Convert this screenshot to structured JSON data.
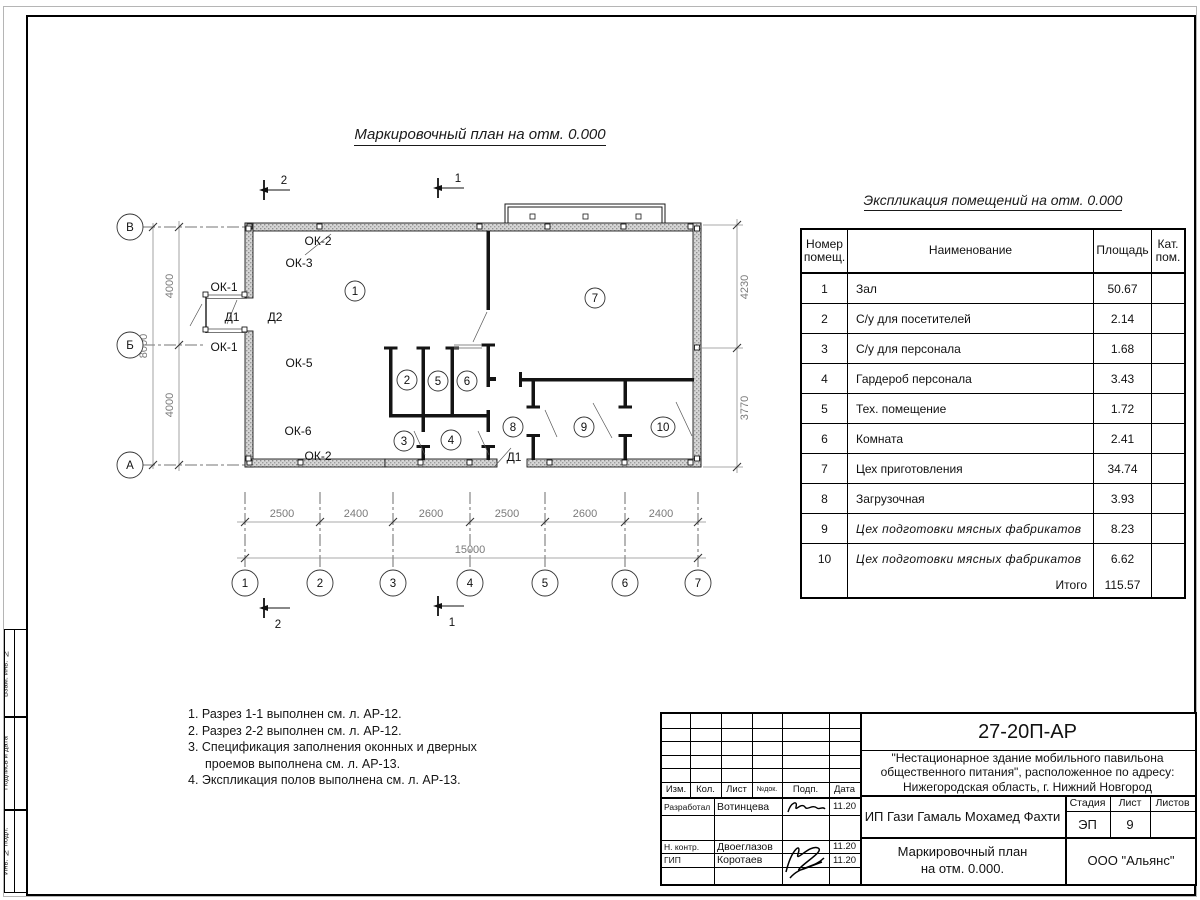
{
  "plan": {
    "title": "Маркировочный план на отм. 0.000",
    "row_axes": [
      "В",
      "Б",
      "А"
    ],
    "col_axes": [
      "1",
      "2",
      "3",
      "4",
      "5",
      "6",
      "7"
    ],
    "dims_bottom": [
      "2500",
      "2400",
      "2600",
      "2500",
      "2600",
      "2400"
    ],
    "dim_total": "15000",
    "dims_left": [
      "4000",
      "4000"
    ],
    "dim_left_total": "8000",
    "dims_right": [
      "4230",
      "3770"
    ],
    "sections": {
      "s1": "1",
      "s2": "2"
    },
    "openings": {
      "ok1": "ОК-1",
      "ok2": "ОК-2",
      "ok3": "ОК-3",
      "ok5": "ОК-5",
      "ok6": "ОК-6",
      "d1": "Д1",
      "d2": "Д2"
    },
    "rooms": [
      "1",
      "2",
      "3",
      "4",
      "5",
      "6",
      "7",
      "8",
      "9",
      "10"
    ]
  },
  "legend": {
    "title": "Экспликация помещений на отм. 0.000",
    "col_headers": [
      "Номер помещ.",
      "Наименование",
      "Площадь",
      "Кат. пом."
    ],
    "rows": [
      {
        "num": "1",
        "name": "Зал",
        "area": "50.67"
      },
      {
        "num": "2",
        "name": "С/у для посетителей",
        "area": "2.14"
      },
      {
        "num": "3",
        "name": "С/у для персонала",
        "area": "1.68"
      },
      {
        "num": "4",
        "name": "Гардероб персонала",
        "area": "3.43"
      },
      {
        "num": "5",
        "name": "Тех. помещение",
        "area": "1.72"
      },
      {
        "num": "6",
        "name": "Комната",
        "area": "2.41"
      },
      {
        "num": "7",
        "name": "Цех приготовления",
        "area": "34.74"
      },
      {
        "num": "8",
        "name": "Загрузочная",
        "area": "3.93"
      },
      {
        "num": "9",
        "name": "Цех подготовки мясных фабрикатов",
        "area": "8.23"
      },
      {
        "num": "10",
        "name": "Цех подготовки мясных фабрикатов",
        "area": "6.62"
      }
    ],
    "total_label": "Итого",
    "total_value": "115.57"
  },
  "notes": [
    "1. Разрез 1-1 выполнен см. л. АР-12.",
    "2. Разрез 2-2 выполнен см. л. АР-12.",
    "3. Спецификация заполнения оконных и дверных проемов выполнена см. л. АР-13.",
    "4. Экспликация полов выполнена см. л. АР-13."
  ],
  "titleblock": {
    "doc_number": "27-20П-АР",
    "project": "\"Нестационарное здание мобильного павильона общественного питания\", расположенное по адресу: Нижегородская область, г. Нижний Новгород",
    "client": "ИП Гази Гамаль Мохамед Фахти",
    "sheet_title_line1": "Маркировочный план",
    "sheet_title_line2": "на отм. 0.000.",
    "company": "ООО \"Альянс\"",
    "stage_label": "Стадия",
    "sheet_label": "Лист",
    "sheets_label": "Листов",
    "stage": "ЭП",
    "sheet_number": "9",
    "header_cols": [
      "Изм.",
      "Кол.",
      "Лист",
      "№док.",
      "Подп.",
      "Дата"
    ],
    "roles": [
      {
        "role": "Разработал",
        "name": "Вотинцева",
        "date": "11.20"
      },
      {
        "role": "Н. контр.",
        "name": "Двоеглазов",
        "date": "11.20"
      },
      {
        "role": "ГИП",
        "name": "Коротаев",
        "date": "11.20"
      }
    ]
  },
  "frame_stamps": [
    "Взам. инв. №",
    "Подпись и дата",
    "Инв. № подл."
  ]
}
